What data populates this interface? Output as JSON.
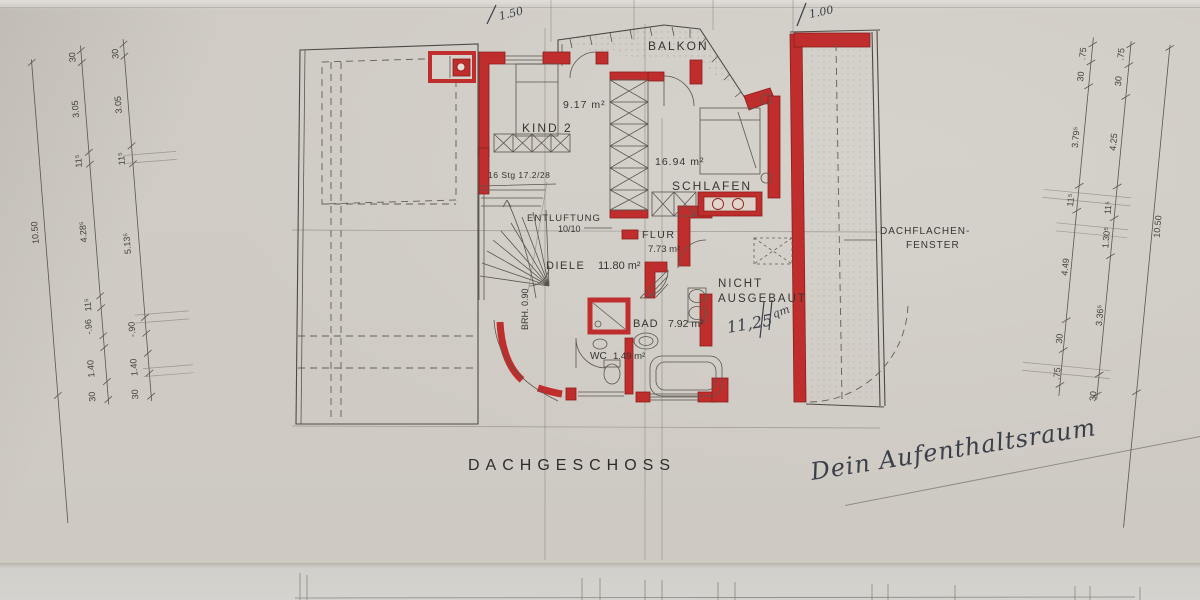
{
  "drawing": {
    "title": "DACHGESCHOSS"
  },
  "rooms": {
    "balkon": {
      "name": "BALKON"
    },
    "kind2": {
      "name": "KIND 2",
      "area": "9.17 m²"
    },
    "schlafen": {
      "name": "SCHLAFEN",
      "area": "16.94 m²"
    },
    "flur": {
      "name": "FLUR",
      "area": "7.73 m²"
    },
    "diele": {
      "name": "DIELE",
      "area": "11.80 m²"
    },
    "bad": {
      "name": "BAD",
      "area": "7.92 m²"
    },
    "wc": {
      "name": "WC",
      "area": "1.49 m²"
    },
    "nicht_ausgebaut": {
      "name_line1": "NICHT",
      "name_line2": "AUSGEBAUT"
    }
  },
  "annotations": {
    "stair_note": "16 Stg 17.2/28",
    "entlueftung_line1": "ENTLUFTUNG",
    "entlueftung_line2": "10/10",
    "brh": "BRH. 0.90",
    "roof_window_line1": "DACHFLACHEN-",
    "roof_window_line2": "FENSTER"
  },
  "handwriting": {
    "top_left": "1.50",
    "top_right": "1.00",
    "area_value": "11,25",
    "area_unit": "qm",
    "bottom_note": "Dein Aufenthaltsraum"
  },
  "dimensions": {
    "left_total": "10.50",
    "left_chain_a": [
      "30",
      "3.05",
      "11⁵",
      "4.28⁵",
      "11⁵",
      "-.96",
      "1.40",
      "30"
    ],
    "left_chain_b": [
      "30",
      "3.05",
      "11⁵",
      "5.13⁵",
      "-.90",
      "1.40",
      "30"
    ],
    "right_chain_a": [
      ".75",
      "30",
      "3.79⁵",
      "11⁵",
      "4.49",
      "30",
      ".75"
    ],
    "right_chain_b": [
      ".75",
      "30",
      "4.25",
      "11⁵",
      "1.30⁵",
      "3.36⁵",
      "30"
    ],
    "right_total": "10.50"
  },
  "colors": {
    "paper": "#cfcbc4",
    "wall_red": "#bf2e2d",
    "ink": "#38342f",
    "pen": "#3a3f49"
  }
}
